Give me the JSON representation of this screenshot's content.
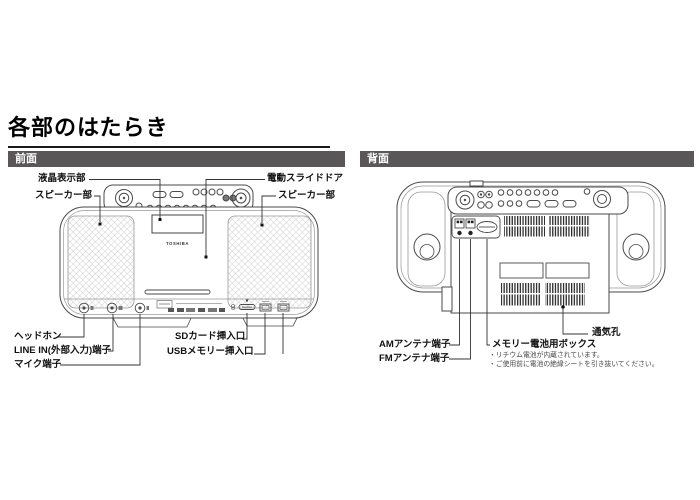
{
  "page": {
    "title": "各部のはたらき"
  },
  "front": {
    "header": "前面",
    "brand": "TOSHIBA",
    "labels": {
      "lcd": "液晶表示部",
      "speaker_left": "スピーカー部",
      "slide_door": "電動スライドドア",
      "speaker_right": "スピーカー部",
      "headphone": "ヘッドホン",
      "line_in": "LINE IN(外部入力)端子",
      "mic": "マイク端子",
      "sd_slot": "SDカード挿入口",
      "usb_slot": "USBメモリー挿入口"
    }
  },
  "back": {
    "header": "背面",
    "labels": {
      "am_antenna": "AMアンテナ端子",
      "fm_antenna": "FMアンテナ端子",
      "memory_battery_box": "メモリー電池用ボックス",
      "vent": "通気孔"
    },
    "notes": [
      "・リチウム電池が内蔵されています。",
      "・ご使用前に電池の絶縁シートを引き抜いてください。"
    ]
  },
  "colors": {
    "header_bg": "#595757",
    "line": "#333333",
    "device_line": "#4a4a4a"
  }
}
